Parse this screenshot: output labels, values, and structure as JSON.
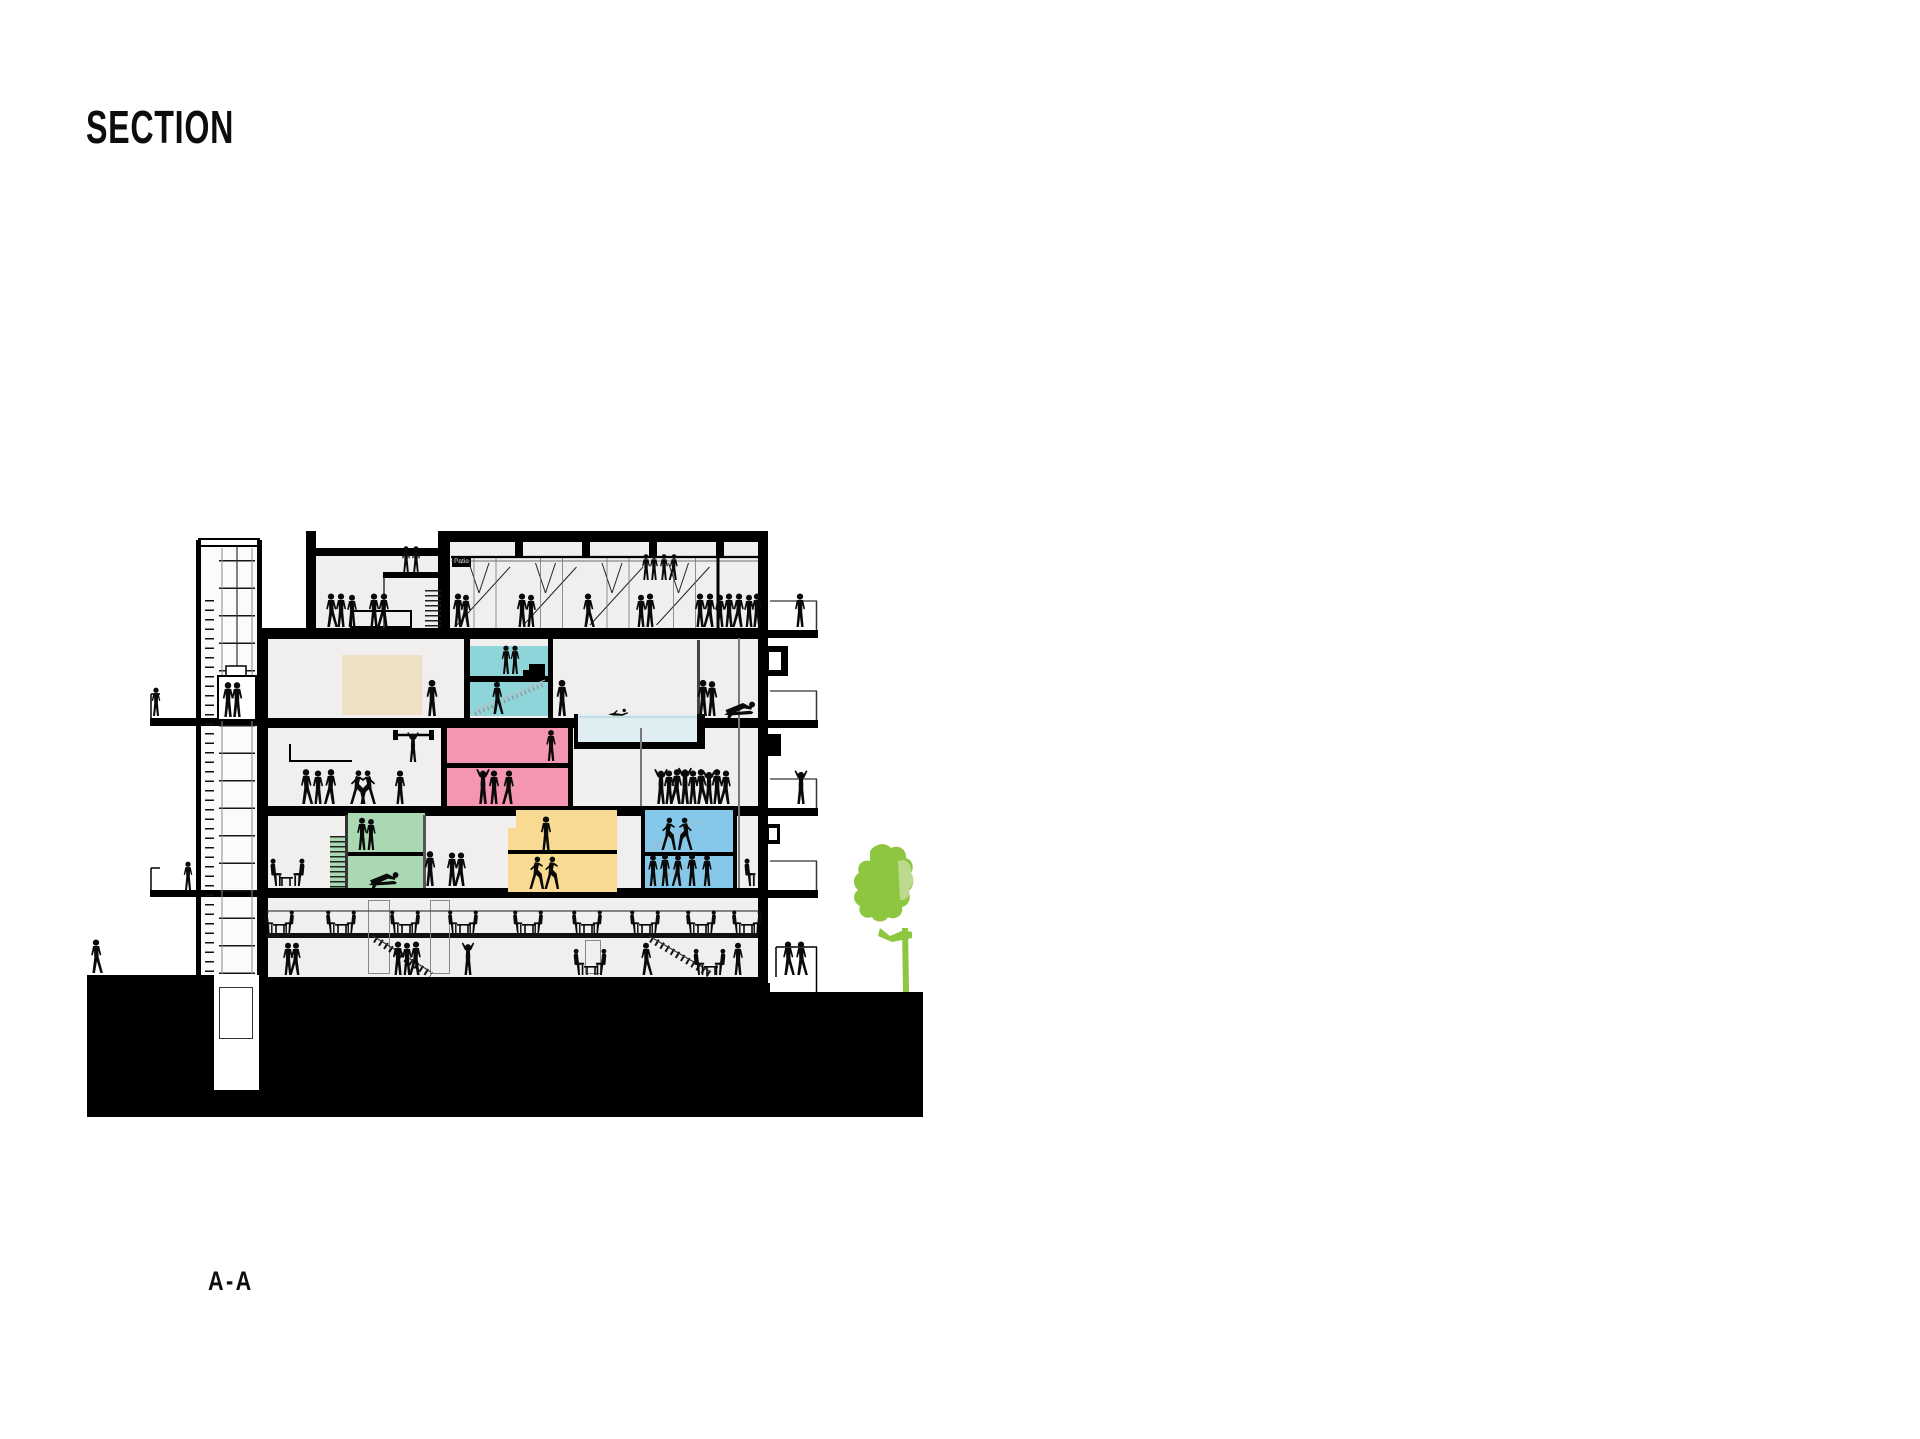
{
  "page": {
    "title": "SECTION",
    "section_label": "A-A"
  },
  "drawing": {
    "name": "building-section-a-a",
    "patio_tag": "Patio",
    "palette": {
      "ink": "#000000",
      "interior": "#f0efed",
      "teal": "#8ed5d9",
      "beige": "#eee1c2",
      "pink": "#f495b1",
      "green": "#a9d8b3",
      "yellow": "#f8da92",
      "blue": "#86c8ea",
      "pool": "#dfeef2",
      "tree": "#8dc63f",
      "tree_light": "#bdd98e",
      "figure": "#0a0a0a",
      "ground": "#000000"
    },
    "rooms": [
      {
        "id": "studio-teal-upper",
        "color": "teal"
      },
      {
        "id": "studio-teal-lower",
        "color": "teal"
      },
      {
        "id": "meeting-box-beige",
        "color": "beige"
      },
      {
        "id": "hall-pink-upper",
        "color": "pink"
      },
      {
        "id": "hall-pink-lower",
        "color": "pink"
      },
      {
        "id": "lounge-green-upper",
        "color": "green"
      },
      {
        "id": "lounge-green-lower",
        "color": "green"
      },
      {
        "id": "studio-yellow-step",
        "color": "yellow"
      },
      {
        "id": "studio-yellow-upper",
        "color": "yellow"
      },
      {
        "id": "studio-yellow-lower",
        "color": "yellow"
      },
      {
        "id": "gym-blue-upper",
        "color": "blue"
      },
      {
        "id": "gym-blue-lower",
        "color": "blue"
      },
      {
        "id": "swimming-pool",
        "color": "pool"
      }
    ]
  }
}
